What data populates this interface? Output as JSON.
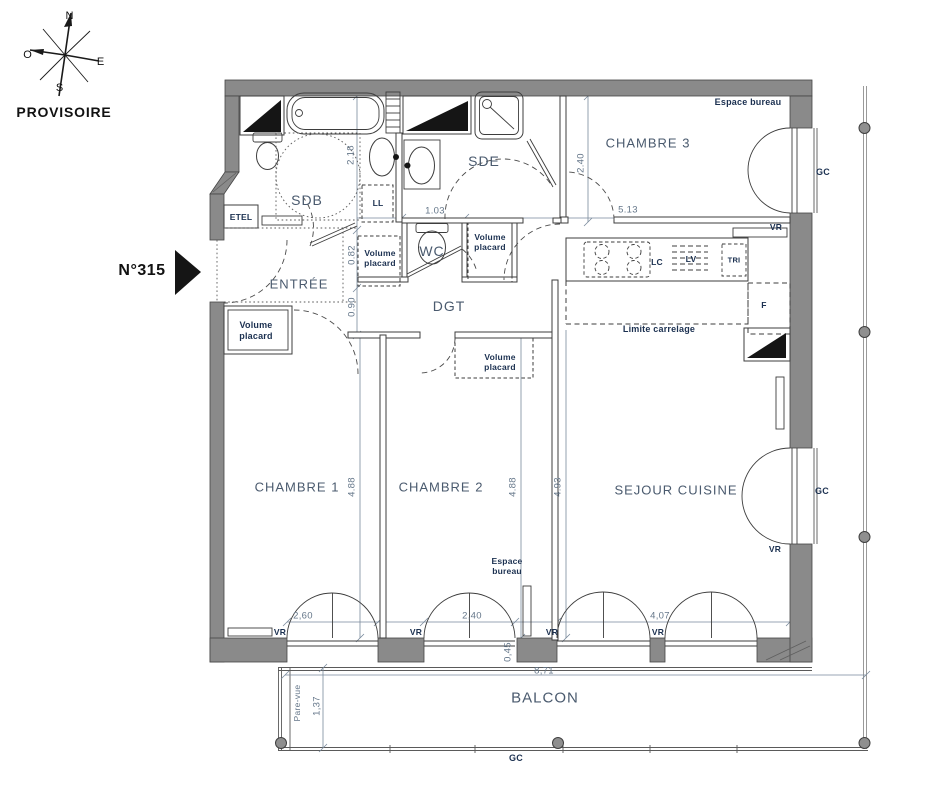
{
  "meta": {
    "status": "PROVISOIRE",
    "unit": "N°315"
  },
  "compass": {
    "n": "N",
    "e": "E",
    "s": "S",
    "o": "O"
  },
  "rooms": {
    "sdb": "SDB",
    "sde": "SDE",
    "wc": "WC",
    "entree": "ENTRÉE",
    "dgt": "DGT",
    "chambre1": "CHAMBRE 1",
    "chambre2": "CHAMBRE 2",
    "chambre3": "CHAMBRE 3",
    "sejour": "SEJOUR CUISINE",
    "balcon": "BALCON"
  },
  "features": {
    "espace_bureau": "Espace bureau",
    "volume_placard": "Volume placard",
    "limite_carrelage": "Limite carrelage",
    "pare_vue": "Pare-vue",
    "etel": "ETEL",
    "lave_linge": "LL",
    "lc": "LC",
    "lave_vaisselle": "LV",
    "tri": "TRI",
    "frigo": "F"
  },
  "window_labels": {
    "volet_roulant": "VR",
    "garde_corps": "GC"
  },
  "dims": {
    "sdb_height": "2.18",
    "placard_entree": "0.82",
    "degagement": "0.90",
    "wc_width": "1.03",
    "ch3_height": "2.40",
    "ch3_width": "5.13",
    "ch1_height": "4.88",
    "ch2_height": "4.88",
    "sejour_height": "4.93",
    "ch1_window": "2,60",
    "ch2_window": "2,40",
    "sejour_window": "4,07",
    "window_pier": "0,45",
    "balcon_width": "8,71",
    "balcon_depth": "1,37"
  },
  "colors": {
    "wall_fill": "#8a8a8a",
    "room_label": "#4a5a6e",
    "annotation": "#1b3050",
    "dimension": "#647689"
  }
}
